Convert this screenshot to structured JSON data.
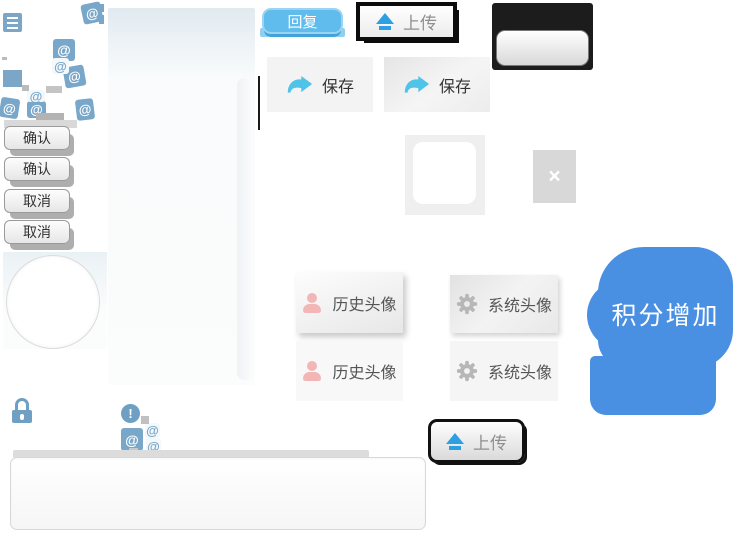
{
  "labels": {
    "confirm": "确认",
    "cancel": "取消",
    "reply": "回复",
    "upload": "上传",
    "save": "保存",
    "history_avatar": "历史头像",
    "system_avatar": "系统头像",
    "points_increase": "积分增加"
  },
  "glyphs": {
    "at": "@",
    "close": "×",
    "alert": "!"
  },
  "icons": {
    "menu": "hamburger-lines",
    "at": "at-symbol",
    "lock": "padlock",
    "alert": "exclamation-circle",
    "close": "cross",
    "upload_arrow": "up-arrow-with-bar",
    "save_arrow": "curved-share-arrow",
    "person": "person-silhouette",
    "gear": "gear"
  },
  "colors": {
    "steel_blue": "#79a7c9",
    "reply_blue": "#60bcec",
    "upload_arrow_blue": "#2d9fe3",
    "save_arrow_blue": "#4fc3e8",
    "bubble_blue": "#4a90e2",
    "person_pink": "#f3b6b6",
    "gear_gray": "#b7b7b7",
    "panel_black": "#1c1c1c"
  }
}
